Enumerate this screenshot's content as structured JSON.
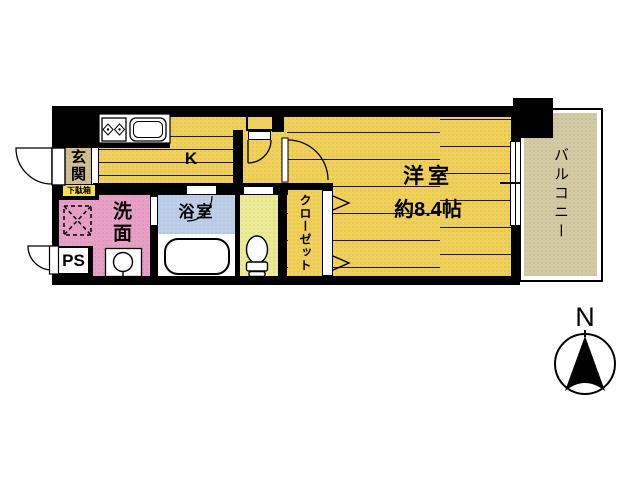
{
  "floor_plan": {
    "entrance_label": "玄関",
    "shoe_cabinet_label": "下駄箱",
    "kitchen_label": "K",
    "washroom_label": "洗面",
    "bathroom_label": "浴室",
    "pipe_space_label": "PS",
    "closet_label": "クローゼット",
    "main_room_label": "洋室",
    "main_room_size": "約8.4帖",
    "balcony_label": "バルコニー",
    "compass_north_label": "N",
    "colors": {
      "floor_yellow": "#f0d058",
      "entrance_tan": "#cfc08d",
      "shoe_cabinet_yellow": "#f6e14e",
      "washroom_pink": "#e79fc6",
      "bathroom_blue": "#bdcfe8",
      "toilet_pale_yellow": "#ebeb95",
      "balcony_beige": "#d3caa3",
      "wall_black": "#000000"
    }
  }
}
